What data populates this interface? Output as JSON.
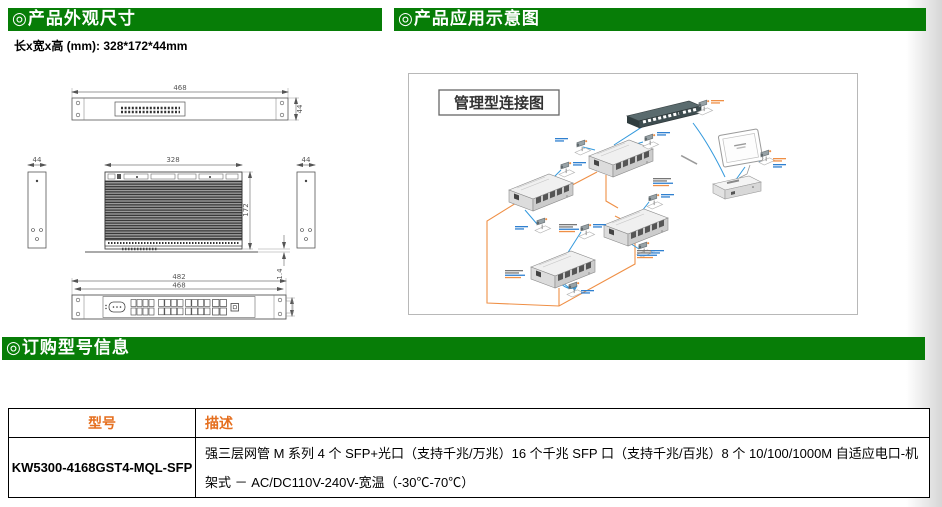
{
  "colors": {
    "header_green": "#077d07",
    "table_header_orange": "#e56f1f",
    "fiber_line_orange": "#ef8f45",
    "copper_line_blue": "#3399dd"
  },
  "sections": {
    "dimensions_title": "◎产品外观尺寸",
    "application_title": "◎产品应用示意图",
    "ordering_title": "◎订购型号信息"
  },
  "dimensions_note": "长x宽x高 (mm): 328*172*44mm",
  "drawing": {
    "top_width": "468",
    "top_height": "44",
    "body_width": "328",
    "body_depth": "172",
    "side_left_width": "44",
    "side_right_width": "44",
    "flange_thickness": "1.4",
    "front_width_outer": "482",
    "front_width_inner": "468"
  },
  "diagram": {
    "title": "管理型连接图"
  },
  "table": {
    "headers": [
      "型号",
      "描述"
    ],
    "rows": [
      {
        "model": "KW5300-4168GST4-MQL-SFP",
        "desc": "强三层网管 M 系列 4 个 SFP+光口（支持千兆/万兆）16 个千兆 SFP 口（支持千兆/百兆）8 个 10/100/1000M 自适应电口-机架式 － AC/DC110V-240V-宽温（-30℃-70℃）"
      }
    ]
  }
}
